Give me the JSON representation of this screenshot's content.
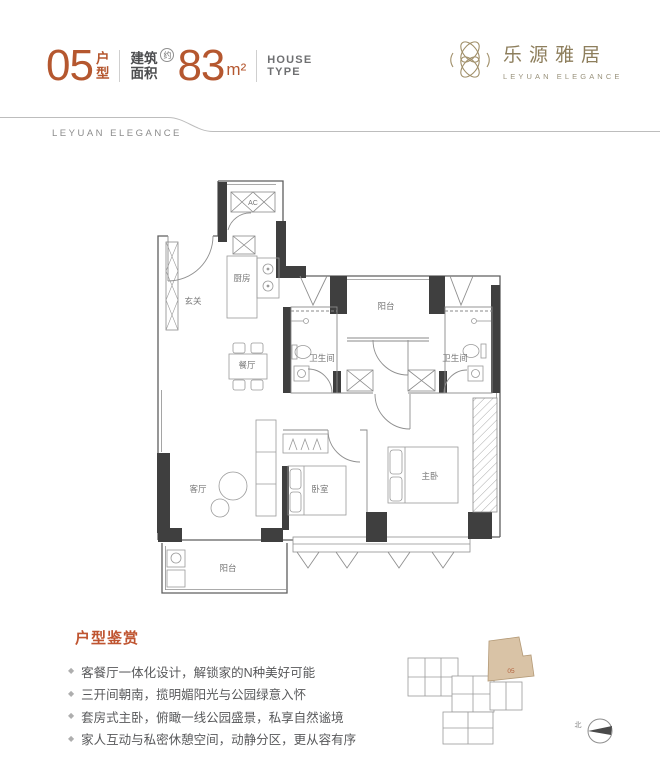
{
  "header": {
    "unit_number": "05",
    "unit_suffix_chars": [
      "户",
      "型"
    ],
    "area_label_chars": [
      "建筑",
      "面积"
    ],
    "area_approx": "约",
    "area_value": "83",
    "area_unit": "m²",
    "house_type_lines": [
      "HOUSE",
      "TYPE"
    ]
  },
  "logo": {
    "cn": "乐源雅居",
    "en": "LEYUAN ELEGANCE"
  },
  "banner": {
    "text": "LEYUAN ELEGANCE"
  },
  "floorplan": {
    "rooms": {
      "entry": "玄关",
      "kitchen": "厨房",
      "dining": "餐厅",
      "living": "客厅",
      "balcony_top": "阳台",
      "balcony_bottom": "阳台",
      "bath_left": "卫生间",
      "bath_right": "卫生间",
      "bedroom": "卧室",
      "master_bedroom": "主卧",
      "ac": "AC"
    }
  },
  "appreciation": {
    "title": "户型鉴赏",
    "bullet_icon": "◆",
    "bullets": [
      "客餐厅一体化设计，解锁家的N种美好可能",
      "三开间朝南，揽明媚阳光与公园绿意入怀",
      "套房式主卧，俯瞰一线公园盛景，私享自然谧境",
      "家人互动与私密休憩空间，动静分区，更从容有序"
    ]
  },
  "keyplan": {
    "unit_label": "05",
    "compass_north": "北"
  },
  "colors": {
    "accent_terracotta": "#b5572f",
    "brand_gold": "#8d7e5c",
    "body_gray": "#58595b",
    "wall_dark": "#3f3f3f",
    "keyplan_highlight": "#d9c3a6"
  }
}
